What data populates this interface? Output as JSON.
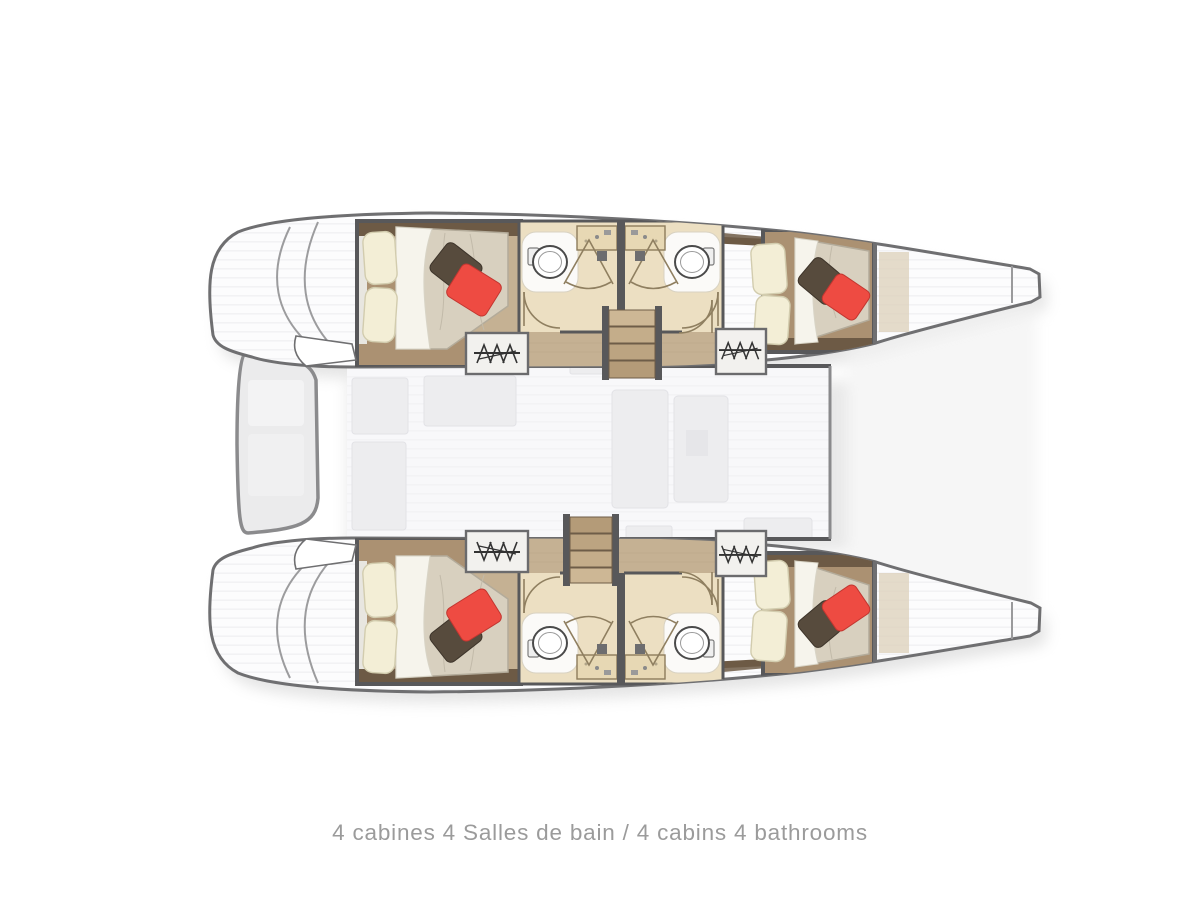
{
  "caption": {
    "text": "4 cabines 4 Salles de bain / 4 cabins 4 bathrooms"
  },
  "plan": {
    "type": "yacht-floor-plan",
    "vessel": "sailing catamaran",
    "orientation": "bow-right-stern-left",
    "cabins_count": 4,
    "bathrooms_count": 4,
    "rooms": [
      {
        "id": "cabin-port-aft",
        "type": "double-cabin",
        "hull": "port",
        "position": "aft",
        "furniture": [
          "double-bed",
          "cream-pillows",
          "grey-accent-pillow",
          "red-accent-pillow",
          "wardrobe"
        ]
      },
      {
        "id": "bathroom-port-aft",
        "type": "bathroom",
        "hull": "port",
        "position": "midship",
        "furniture": [
          "toilet",
          "vanity-sink",
          "shower-cubicle",
          "door"
        ]
      },
      {
        "id": "bathroom-port-fwd",
        "type": "bathroom",
        "hull": "port",
        "position": "midship",
        "furniture": [
          "toilet",
          "vanity-sink",
          "shower-cubicle",
          "door"
        ]
      },
      {
        "id": "cabin-port-fwd",
        "type": "double-cabin",
        "hull": "port",
        "position": "forward",
        "furniture": [
          "double-bed",
          "cream-pillows",
          "grey-accent-pillow",
          "red-accent-pillow",
          "wardrobe"
        ]
      },
      {
        "id": "cabin-starboard-aft",
        "type": "double-cabin",
        "hull": "starboard",
        "position": "aft",
        "furniture": [
          "double-bed",
          "cream-pillows",
          "grey-accent-pillow",
          "red-accent-pillow",
          "wardrobe"
        ]
      },
      {
        "id": "bathroom-starboard-aft",
        "type": "bathroom",
        "hull": "starboard",
        "position": "midship",
        "furniture": [
          "toilet",
          "vanity-sink",
          "shower-cubicle",
          "door"
        ]
      },
      {
        "id": "bathroom-starboard-fwd",
        "type": "bathroom",
        "hull": "starboard",
        "position": "midship",
        "furniture": [
          "toilet",
          "vanity-sink",
          "shower-cubicle",
          "door"
        ]
      },
      {
        "id": "cabin-starboard-fwd",
        "type": "double-cabin",
        "hull": "starboard",
        "position": "forward",
        "furniture": [
          "double-bed",
          "cream-pillows",
          "grey-accent-pillow",
          "red-accent-pillow",
          "wardrobe"
        ]
      },
      {
        "id": "salon",
        "type": "salon-bridgedeck",
        "position": "center",
        "furniture": [
          "galley",
          "settee",
          "table"
        ]
      },
      {
        "id": "cockpit",
        "type": "cockpit",
        "position": "aft-center",
        "furniture": [
          "bench-seats"
        ]
      },
      {
        "id": "forepeak-port",
        "type": "bow-locker",
        "hull": "port",
        "position": "bow"
      },
      {
        "id": "forepeak-starboard",
        "type": "bow-locker",
        "hull": "starboard",
        "position": "bow"
      }
    ],
    "connections": [
      "staircase-port-hull",
      "staircase-starboard-hull",
      "stern-steps"
    ],
    "icons": {
      "wardrobe-hangers-icon": "rectangle with rod and clothes hangers",
      "toilet-icon": "round bowl with tank",
      "shower-door-icon": "fan of glass door lines",
      "stairs-icon": "stacked wooden treads"
    }
  },
  "colors": {
    "background": "#ffffff",
    "hull_outline": "#6f6f71",
    "wall": "#58585a",
    "wood_dark": "#6d5a45",
    "wood_mid": "#ab9172",
    "wood_light": "#c5b193",
    "wood_pale": "#e7d8b4",
    "bathroom_floor": "#ecdfc2",
    "mattress": "#d8d0bf",
    "sheet": "#f6f4ec",
    "pillow_cream": "#f3eed6",
    "pillow_dark": "#574b3d",
    "pillow_red": "#ee4b42",
    "salon_fill": "#f4f4f6",
    "furniture_faint": "#ededef",
    "stairs_wood": "#c6b08c",
    "caption_text": "#9b9b9b",
    "shadow": "#c4c4c4"
  }
}
